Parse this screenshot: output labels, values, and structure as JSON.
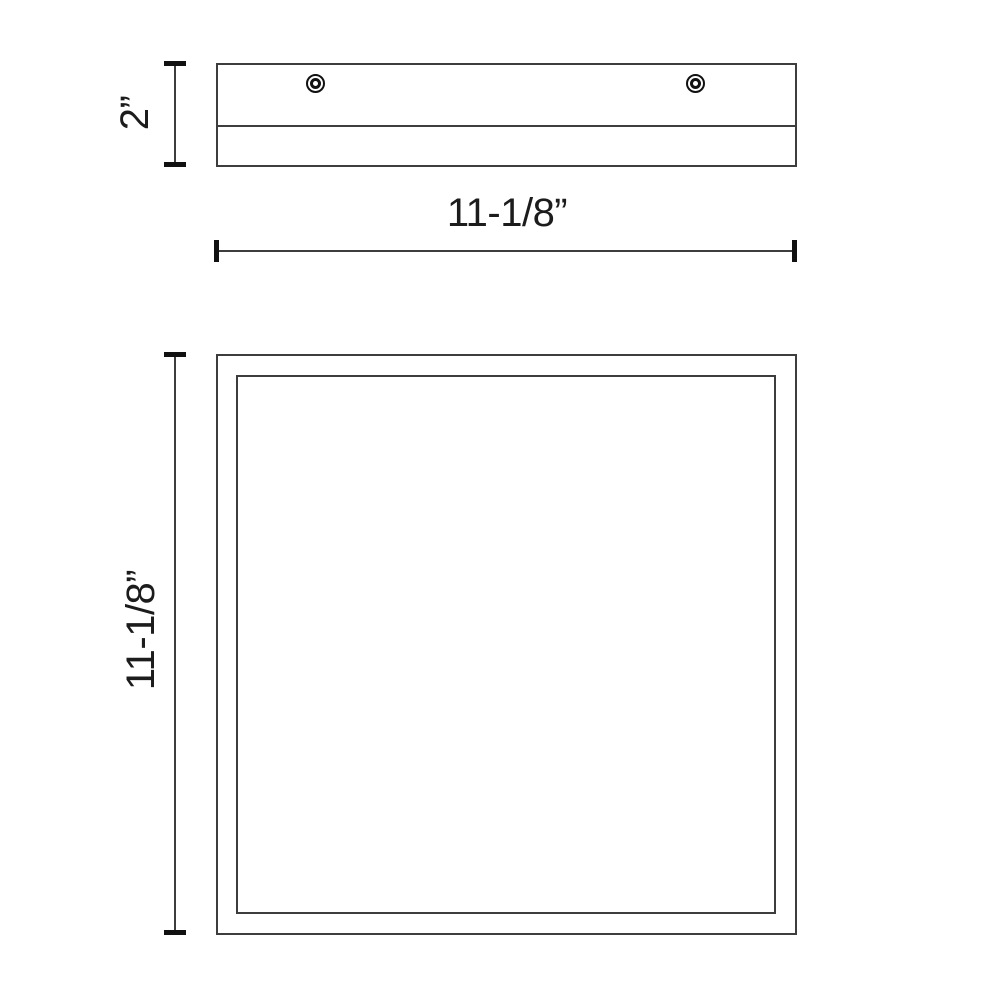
{
  "colors": {
    "line": "#3d3d3d",
    "tick": "#111111",
    "text": "#1c1c1c",
    "bg": "#ffffff"
  },
  "views": {
    "side": {
      "height_label": "2”",
      "width_label": "11-1/8”",
      "screw_hole_count": 2
    },
    "front": {
      "height_label": "11-1/8”"
    }
  }
}
